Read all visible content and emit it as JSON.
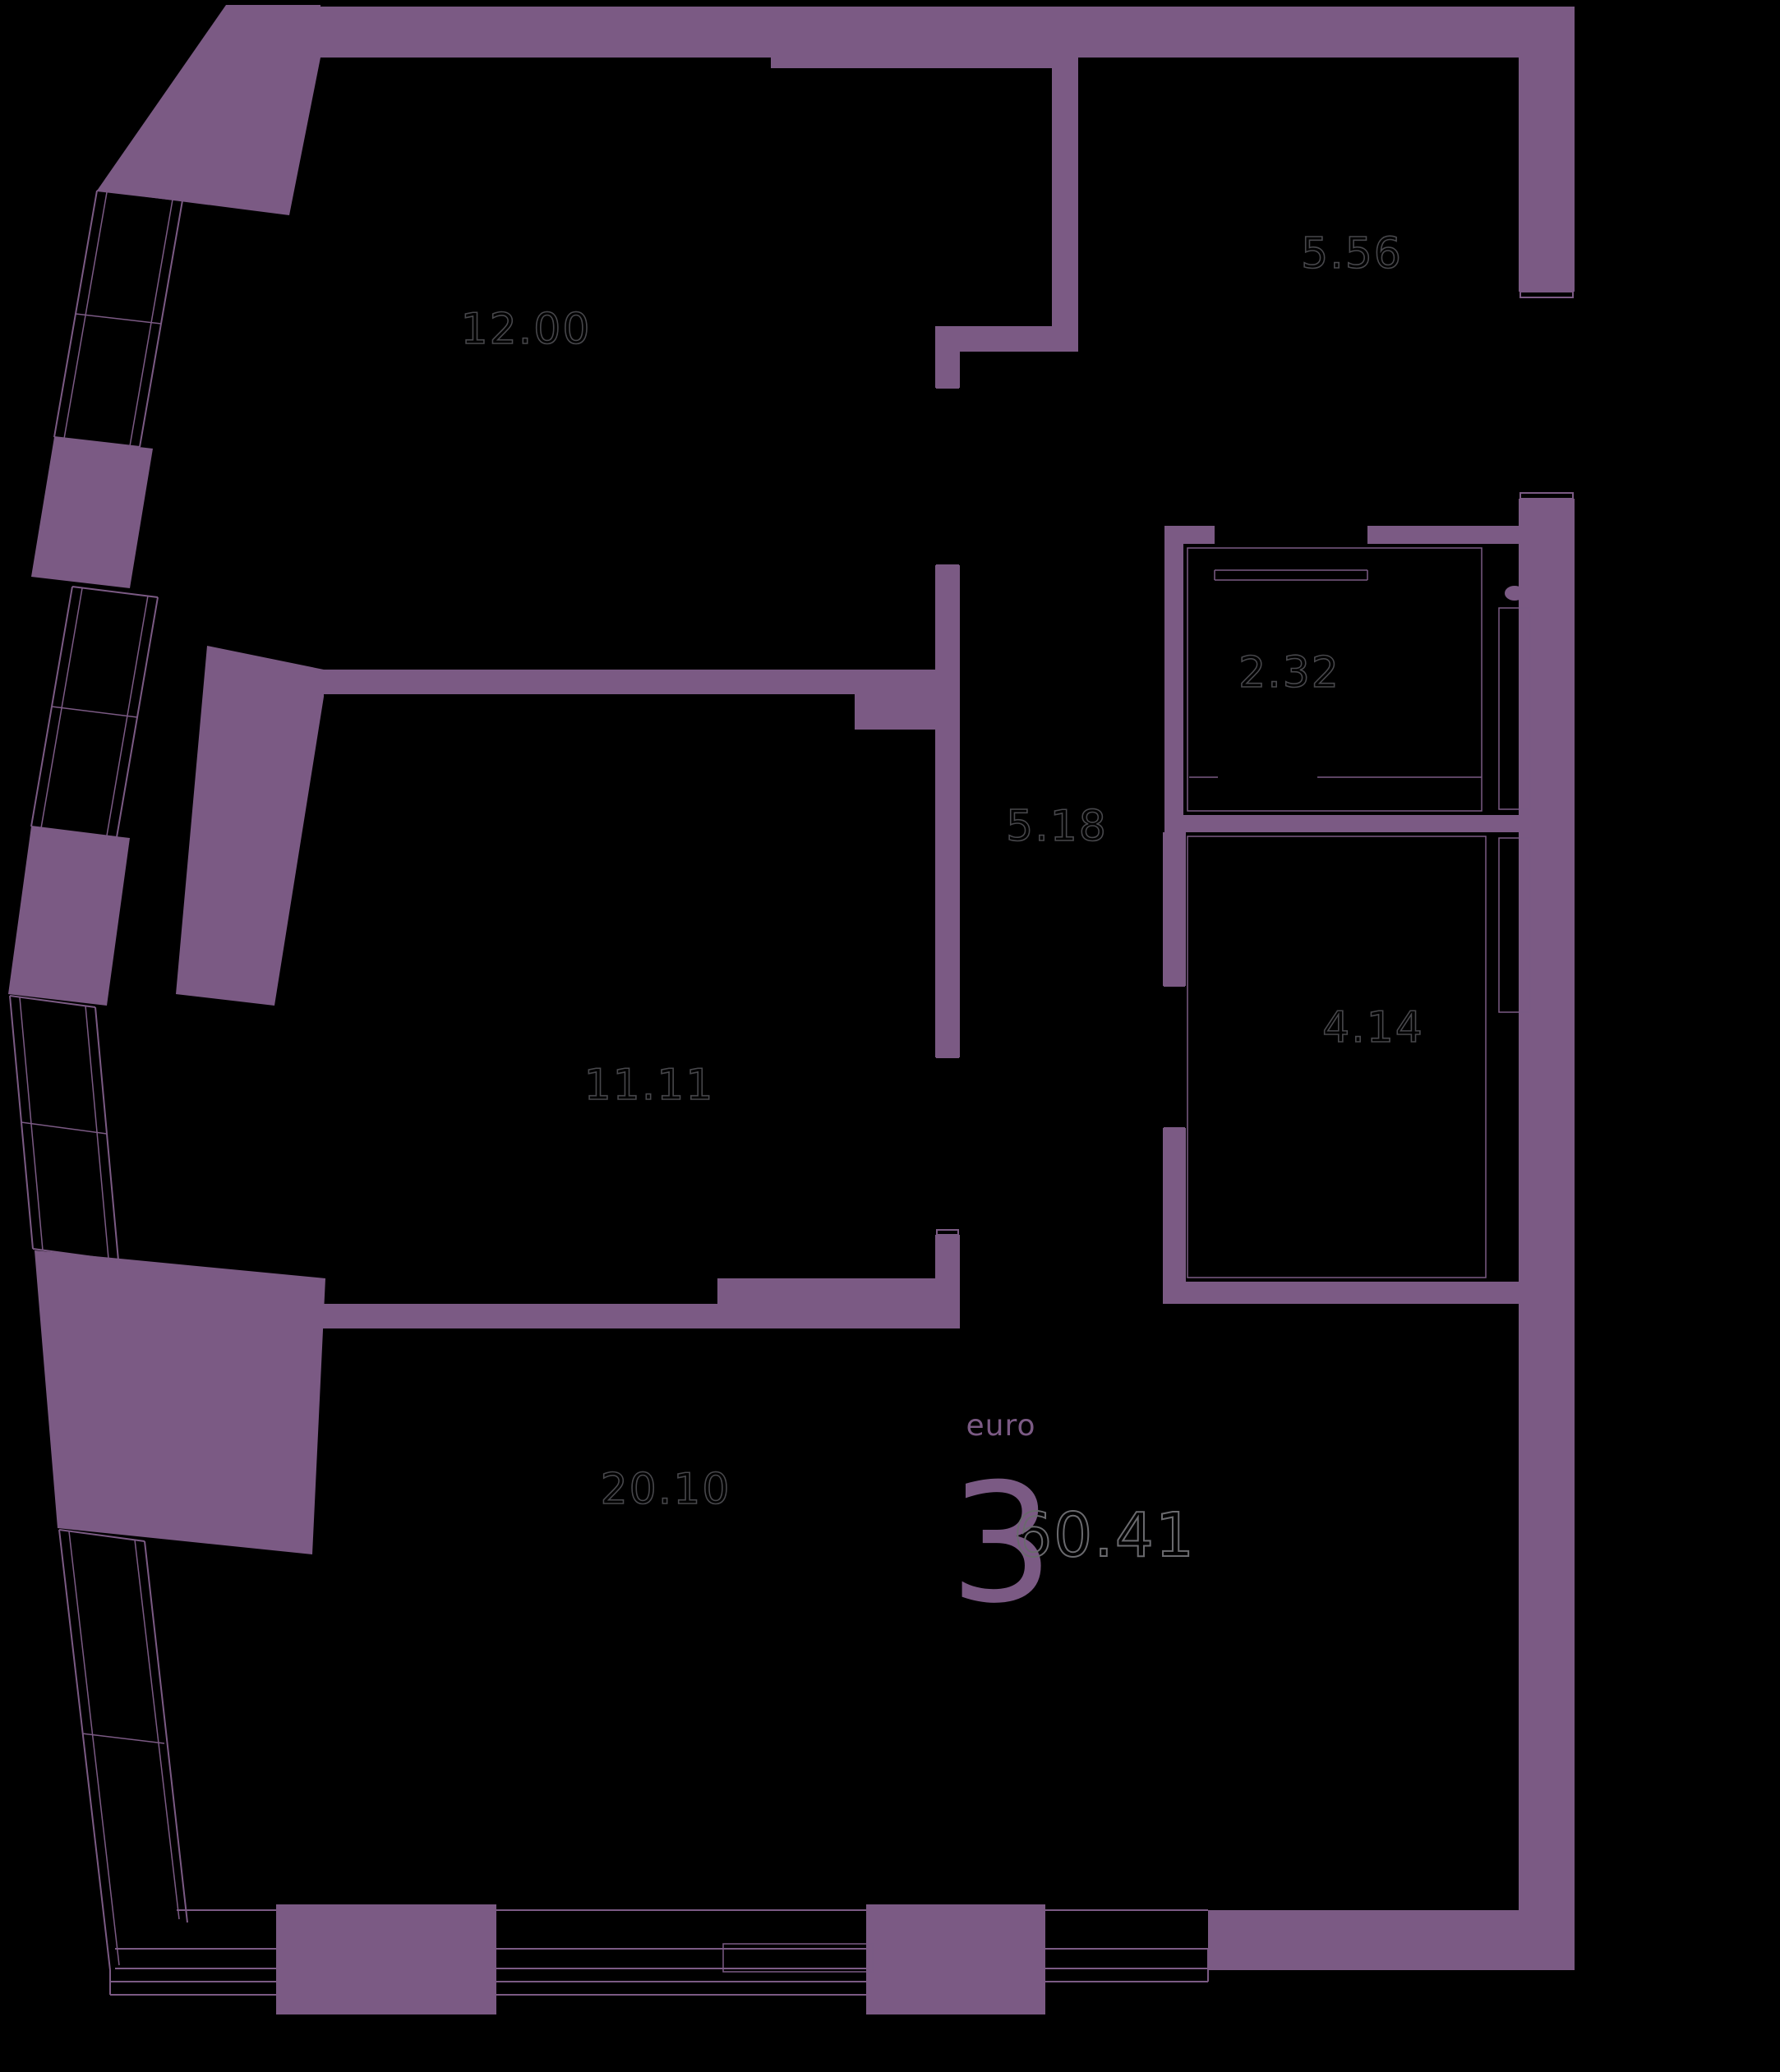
{
  "plan": {
    "type_label": "euro",
    "rooms_count": "3",
    "total_area": "60.41"
  },
  "rooms": [
    {
      "name": "bedroom-top-left",
      "area": "12.00"
    },
    {
      "name": "entrance-hall-top-right",
      "area": "5.56"
    },
    {
      "name": "wardrobe",
      "area": "2.32"
    },
    {
      "name": "corridor",
      "area": "5.18"
    },
    {
      "name": "bathroom",
      "area": "4.14"
    },
    {
      "name": "bedroom-middle-left",
      "area": "11.11"
    },
    {
      "name": "living-kitchen",
      "area": "20.10"
    }
  ],
  "colors": {
    "background": "#000000",
    "wall": "#7b5a84",
    "room_area_outline": "#47474b",
    "total_area_outline": "#6a6a6e",
    "accent_text": "#7b5a84"
  }
}
